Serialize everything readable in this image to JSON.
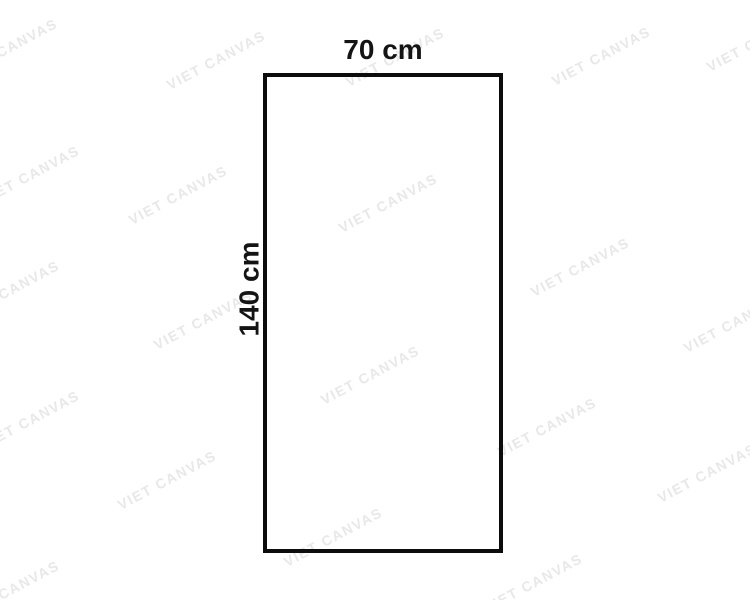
{
  "diagram": {
    "shape": "rectangle",
    "width_label": "70 cm",
    "height_label": "140 cm"
  },
  "watermark": {
    "text": "VIET CANVAS",
    "color": "#e8e8e8",
    "angle_deg": -28,
    "positions": [
      {
        "x": 8,
        "y": 48
      },
      {
        "x": 216,
        "y": 60
      },
      {
        "x": 395,
        "y": 57
      },
      {
        "x": 601,
        "y": 56
      },
      {
        "x": 756,
        "y": 42
      },
      {
        "x": 30,
        "y": 175
      },
      {
        "x": 178,
        "y": 195
      },
      {
        "x": 388,
        "y": 203
      },
      {
        "x": 10,
        "y": 290
      },
      {
        "x": 203,
        "y": 320
      },
      {
        "x": 580,
        "y": 267
      },
      {
        "x": 733,
        "y": 323
      },
      {
        "x": 30,
        "y": 420
      },
      {
        "x": 370,
        "y": 375
      },
      {
        "x": 547,
        "y": 427
      },
      {
        "x": 167,
        "y": 480
      },
      {
        "x": 333,
        "y": 537
      },
      {
        "x": 707,
        "y": 473
      },
      {
        "x": 533,
        "y": 583
      },
      {
        "x": 10,
        "y": 590
      }
    ]
  },
  "colors": {
    "background": "#ffffff",
    "outline": "#0c0c0c",
    "label_text": "#141414"
  }
}
